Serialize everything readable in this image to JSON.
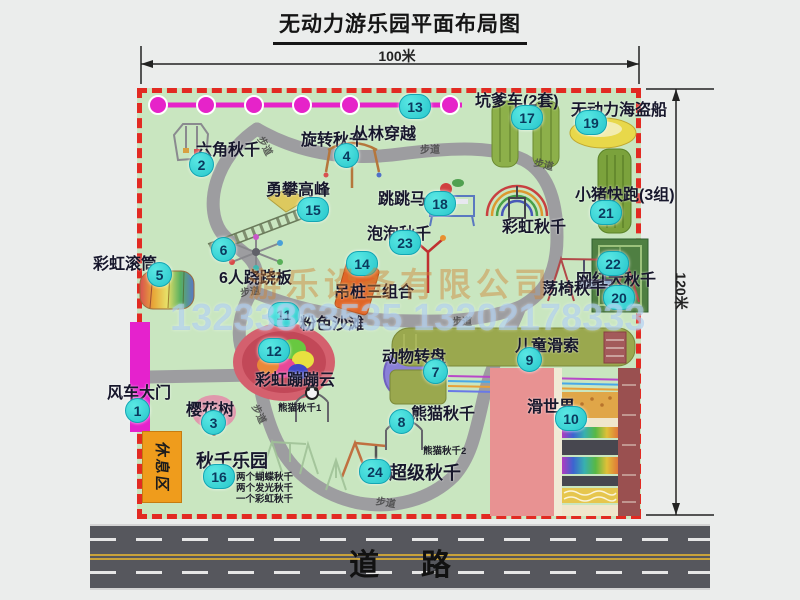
{
  "title": "无动力游乐园平面布局图",
  "dim_top": "100米",
  "dim_right": "120米",
  "road_label": "道     路",
  "path_label": "步道",
  "rest_area_label": "休息区",
  "watermark_company": "游乐设备有限公司",
  "watermark_phone": "13233863535 13202178333",
  "rainbow_swing_label": "彩虹秋千",
  "panda_swing_1_label": "熊猫秋千1",
  "panda_swing_2_label": "熊猫秋千2",
  "swing_park_notes": [
    "两个蝴蝶秋千",
    "两个发光秋千",
    "一个彩虹秋千"
  ],
  "attractions": [
    {
      "num": "1",
      "name": "风车大门"
    },
    {
      "num": "2",
      "name": "六角秋千"
    },
    {
      "num": "3",
      "name": "樱花树"
    },
    {
      "num": "4",
      "name": "旋转秋千"
    },
    {
      "num": "5",
      "name": "彩虹滚筒"
    },
    {
      "num": "6",
      "name": "6人跷跷板"
    },
    {
      "num": "7",
      "name": "动物转盘"
    },
    {
      "num": "8",
      "name": "熊猫秋千"
    },
    {
      "num": "9",
      "name": "儿童滑索"
    },
    {
      "num": "10",
      "name": "滑世界"
    },
    {
      "num": "11",
      "name": "粉色沙滩"
    },
    {
      "num": "12",
      "name": "彩虹蹦蹦云"
    },
    {
      "num": "13",
      "name": "丛林穿越"
    },
    {
      "num": "14",
      "name": "吊桩三组合"
    },
    {
      "num": "15",
      "name": "勇攀高峰"
    },
    {
      "num": "16",
      "name": "秋千乐园"
    },
    {
      "num": "17",
      "name": "坑爹车(2套)"
    },
    {
      "num": "18",
      "name": "跳跳马"
    },
    {
      "num": "19",
      "name": "无动力海盗船"
    },
    {
      "num": "20",
      "name": "网红大秋千"
    },
    {
      "num": "21",
      "name": "小猪快跑(3组)"
    },
    {
      "num": "22",
      "name": "荡椅秋千"
    },
    {
      "num": "23",
      "name": "泡泡秋千"
    },
    {
      "num": "24",
      "name": "超级秋千"
    }
  ]
}
